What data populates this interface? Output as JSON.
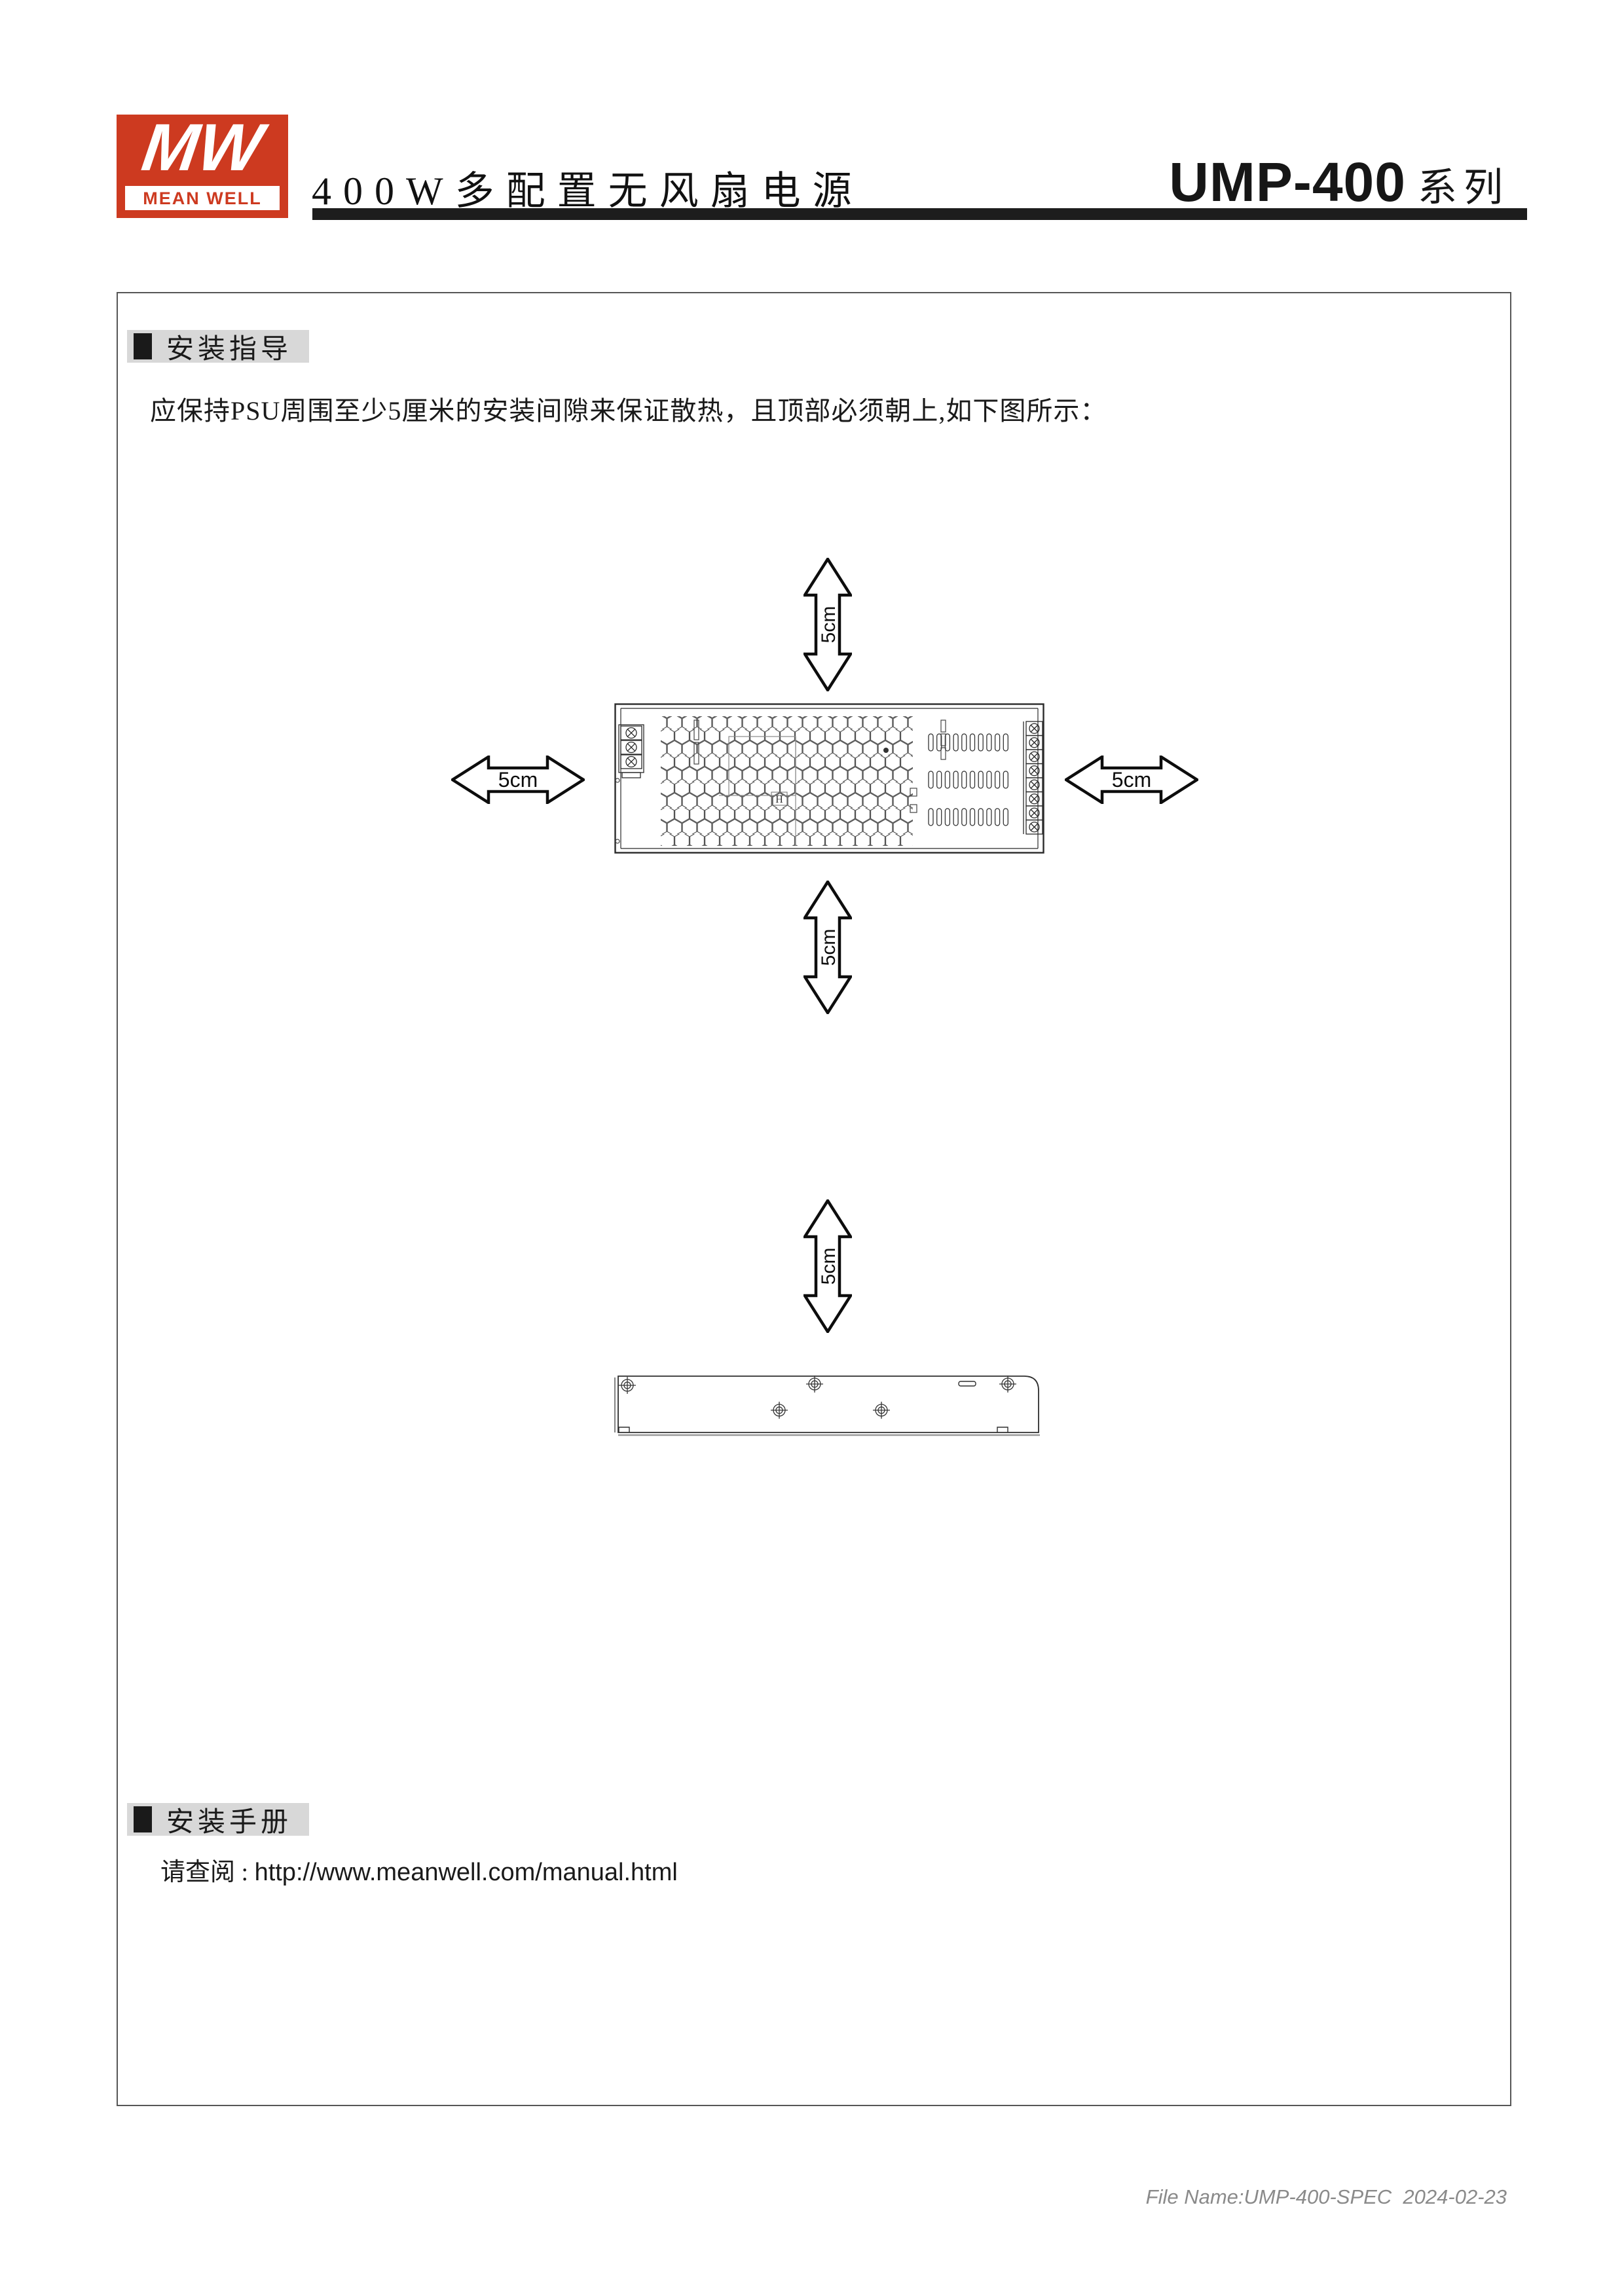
{
  "header": {
    "logo_text": "MW",
    "logo_brand": "MEAN WELL",
    "title": "400W多配置无风扇电源",
    "series_model": "UMP-400",
    "series_suffix": "系列"
  },
  "sections": {
    "guide": {
      "title": "安装指导",
      "body": "应保持PSU周围至少5厘米的安装间隙来保证散热，且顶部必须朝上,如下图所示："
    },
    "manual": {
      "title": "安装手册",
      "note_prefix": "请查阅 : ",
      "url": "http://www.meanwell.com/manual.html"
    }
  },
  "diagram": {
    "clearance_labels": {
      "top": "5cm",
      "bottom": "5cm",
      "left": "5cm",
      "right": "5cm",
      "side": "5cm"
    },
    "psu_marking": "H"
  },
  "footer": {
    "file_info": "File Name:UMP-400-SPEC  2024-02-23"
  },
  "colors": {
    "brand_red": "#cd3a20",
    "section_header_gray": "#d8d8d8",
    "rule_black": "#1d1d1d"
  }
}
